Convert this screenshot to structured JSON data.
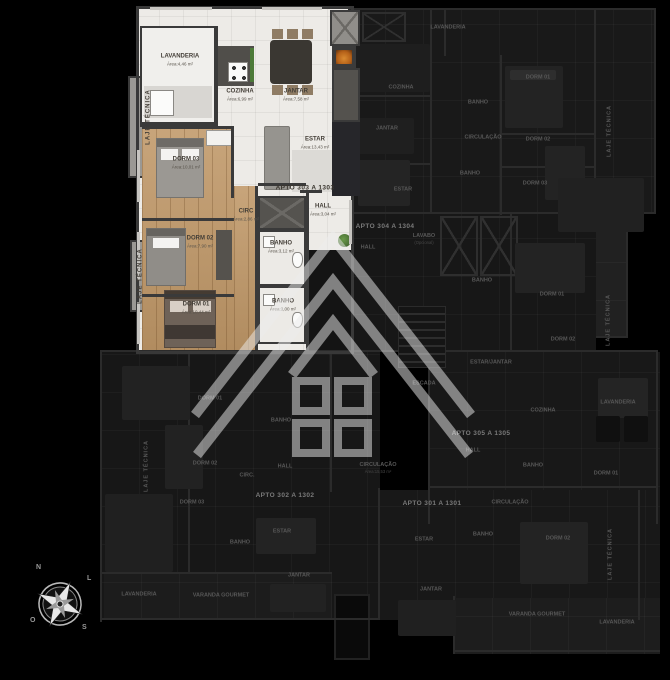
{
  "highlighted_unit": {
    "unit_label": "APTO 303 A 1303",
    "unit_label_pos": {
      "x": 305,
      "y": 188
    },
    "room_labels": [
      {
        "name": "LAVANDERIA",
        "area": "Área:4,46 m²",
        "x": 180,
        "y": 60
      },
      {
        "name": "COZINHA",
        "area": "Área:6,99 m²",
        "x": 240,
        "y": 95
      },
      {
        "name": "JANTAR",
        "area": "Área:7,58 m²",
        "x": 296,
        "y": 95
      },
      {
        "name": "ESTAR",
        "area": "Área:13,43 m²",
        "x": 315,
        "y": 143
      },
      {
        "name": "DORM 03",
        "area": "Área:10,01 m²",
        "x": 186,
        "y": 163
      },
      {
        "name": "CIRC",
        "area": "Área:2,86 m²",
        "x": 246,
        "y": 215
      },
      {
        "name": "DORM 02",
        "area": "Área:7,90 m²",
        "x": 200,
        "y": 242
      },
      {
        "name": "BANHO",
        "area": "Área:3,12 m²",
        "x": 281,
        "y": 247
      },
      {
        "name": "DORM 01",
        "area": "Área:10,44 m²",
        "x": 196,
        "y": 308
      },
      {
        "name": "BANHO",
        "area": "Área:3,00 m²",
        "x": 283,
        "y": 305
      },
      {
        "name": "HALL",
        "area": "Área:3,04 m²",
        "x": 323,
        "y": 210
      },
      {
        "name": "LAJE TÉCNICA",
        "x": 149,
        "y": 117,
        "rot": true
      },
      {
        "name": "LAJE TÉCNICA",
        "x": 141,
        "y": 276,
        "rot": true
      }
    ]
  },
  "dark_labels": [
    {
      "t": "LAVANDERIA",
      "x": 448,
      "y": 28
    },
    {
      "t": "COZINHA",
      "x": 401,
      "y": 88
    },
    {
      "t": "JANTAR",
      "x": 387,
      "y": 129
    },
    {
      "t": "ESTAR",
      "x": 403,
      "y": 190
    },
    {
      "t": "BANHO",
      "x": 478,
      "y": 103
    },
    {
      "t": "CIRCULAÇÃO",
      "x": 483,
      "y": 138
    },
    {
      "t": "BANHO",
      "x": 470,
      "y": 174
    },
    {
      "t": "DORM 01",
      "x": 538,
      "y": 78
    },
    {
      "t": "DORM 02",
      "x": 538,
      "y": 140
    },
    {
      "t": "DORM 03",
      "x": 535,
      "y": 184
    },
    {
      "t": "LAVABO",
      "s": "(Opcional)",
      "x": 424,
      "y": 239
    },
    {
      "t": "HALL",
      "x": 368,
      "y": 248
    },
    {
      "t": "APTO 304 A 1304",
      "x": 385,
      "y": 227,
      "u": true
    },
    {
      "t": "LAJE TÉCNICA",
      "x": 610,
      "y": 131,
      "r": true
    },
    {
      "t": "BANHO",
      "x": 482,
      "y": 281
    },
    {
      "t": "DORM 01",
      "x": 552,
      "y": 295
    },
    {
      "t": "DORM 02",
      "x": 563,
      "y": 340
    },
    {
      "t": "LAJE TÉCNICA",
      "x": 609,
      "y": 320,
      "r": true
    },
    {
      "t": "ESCADA",
      "x": 424,
      "y": 384
    },
    {
      "t": "ESTAR/JANTAR",
      "x": 491,
      "y": 363
    },
    {
      "t": "COZINHA",
      "x": 543,
      "y": 411
    },
    {
      "t": "LAVANDERIA",
      "x": 618,
      "y": 403
    },
    {
      "t": "APTO 305 A 1305",
      "x": 481,
      "y": 434,
      "u": true
    },
    {
      "t": "HALL",
      "x": 473,
      "y": 451
    },
    {
      "t": "BANHO",
      "x": 533,
      "y": 466
    },
    {
      "t": "DORM 01",
      "x": 606,
      "y": 474
    },
    {
      "t": "CIRCULAÇÃO",
      "x": 510,
      "y": 503
    },
    {
      "t": "CIRCULAÇÃO",
      "s": "Área:15,53 m²",
      "x": 378,
      "y": 468
    },
    {
      "t": "HALL",
      "x": 285,
      "y": 467
    },
    {
      "t": "BANHO",
      "x": 281,
      "y": 421
    },
    {
      "t": "APTO 302 A 1302",
      "x": 285,
      "y": 496,
      "u": true
    },
    {
      "t": "APTO 301 A 1301",
      "x": 432,
      "y": 504,
      "u": true
    },
    {
      "t": "DORM 01",
      "x": 210,
      "y": 399
    },
    {
      "t": "DORM 02",
      "x": 205,
      "y": 464
    },
    {
      "t": "CIRC.",
      "x": 247,
      "y": 476
    },
    {
      "t": "DORM 03",
      "x": 192,
      "y": 503
    },
    {
      "t": "LAJE TÉCNICA",
      "x": 147,
      "y": 466,
      "r": true
    },
    {
      "t": "BANHO",
      "x": 240,
      "y": 543
    },
    {
      "t": "ESTAR",
      "x": 282,
      "y": 532
    },
    {
      "t": "LAVANDERIA",
      "x": 139,
      "y": 595
    },
    {
      "t": "VARANDA GOURMET",
      "x": 221,
      "y": 596
    },
    {
      "t": "JANTAR",
      "x": 299,
      "y": 576
    },
    {
      "t": "ESTAR",
      "x": 424,
      "y": 540
    },
    {
      "t": "BANHO",
      "x": 483,
      "y": 535
    },
    {
      "t": "DORM 02",
      "x": 558,
      "y": 539
    },
    {
      "t": "JANTAR",
      "x": 431,
      "y": 590
    },
    {
      "t": "VARANDA GOURMET",
      "x": 537,
      "y": 615
    },
    {
      "t": "LAVANDERIA",
      "x": 617,
      "y": 623
    },
    {
      "t": "LAJE TÉCNICA",
      "x": 611,
      "y": 554,
      "r": true
    }
  ],
  "compass": {
    "n": "N",
    "l": "L",
    "o": "O",
    "s": "S"
  },
  "colors": {
    "wood": "#c09868",
    "tile": "#edebe7",
    "wall": "#3a3a3a",
    "dark_floor": "#181818",
    "fireplace": "#b46018",
    "plant": "#4c7a38",
    "watermark": "#ededed"
  }
}
